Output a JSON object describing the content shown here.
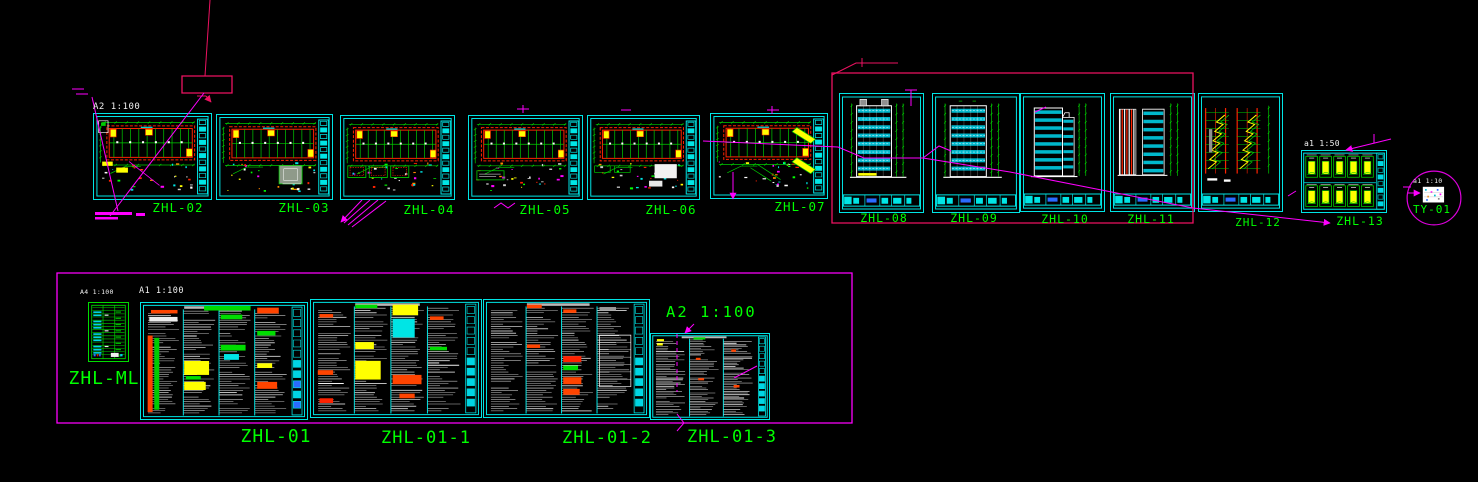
{
  "app": {
    "view": "cad-model-space-overview"
  },
  "palette": {
    "cyan": "#00e5e5",
    "green": "#00ff00",
    "dimgreen": "#00cc00",
    "magenta": "#ff00ff",
    "crimson": "#ed1261",
    "yellow": "#ffff00",
    "red": "#ff2200",
    "white": "#ffffff",
    "blue": "#2a6bff",
    "gray": "#909090",
    "band": "#00b8cc"
  },
  "sheets": [
    {
      "id": "ZHL-02",
      "label": "ZHL-02",
      "type": "plan",
      "special": "02",
      "x": 93,
      "y": 113,
      "w": 119,
      "h": 87,
      "lx": 178,
      "ly": 202,
      "fs": 12.5
    },
    {
      "id": "ZHL-03",
      "label": "ZHL-03",
      "type": "plan",
      "special": "03",
      "x": 216,
      "y": 114,
      "w": 117,
      "h": 86,
      "lx": 304,
      "ly": 202,
      "fs": 12.5
    },
    {
      "id": "ZHL-04",
      "label": "ZHL-04",
      "type": "plan",
      "special": "04",
      "x": 340,
      "y": 115,
      "w": 115,
      "h": 85,
      "lx": 429,
      "ly": 204,
      "fs": 12.5
    },
    {
      "id": "ZHL-05",
      "label": "ZHL-05",
      "type": "plan",
      "special": "05",
      "x": 468,
      "y": 115,
      "w": 115,
      "h": 85,
      "lx": 545,
      "ly": 204,
      "fs": 12.5
    },
    {
      "id": "ZHL-06",
      "label": "ZHL-06",
      "type": "plan",
      "special": "06",
      "x": 587,
      "y": 115,
      "w": 113,
      "h": 85,
      "lx": 671,
      "ly": 204,
      "fs": 12.5
    },
    {
      "id": "ZHL-07",
      "label": "ZHL-07",
      "type": "plan",
      "special": "07",
      "x": 710,
      "y": 113,
      "w": 118,
      "h": 86,
      "lx": 800,
      "ly": 201,
      "fs": 12.5
    },
    {
      "id": "ZHL-08",
      "label": "ZHL-08",
      "type": "elev",
      "kind": "front",
      "roof": true,
      "x": 839,
      "y": 93,
      "w": 85,
      "h": 120,
      "lx": 884,
      "ly": 213,
      "fs": 11.5
    },
    {
      "id": "ZHL-09",
      "label": "ZHL-09",
      "type": "elev",
      "kind": "front",
      "roof": false,
      "x": 932,
      "y": 93,
      "w": 88,
      "h": 120,
      "lx": 974,
      "ly": 213,
      "fs": 11.5
    },
    {
      "id": "ZHL-10",
      "label": "ZHL-10",
      "type": "elev",
      "kind": "step",
      "x": 1020,
      "y": 93,
      "w": 85,
      "h": 119,
      "lx": 1065,
      "ly": 214,
      "fs": 11.5
    },
    {
      "id": "ZHL-11",
      "label": "ZHL-11",
      "type": "elev",
      "kind": "pair",
      "x": 1110,
      "y": 93,
      "w": 85,
      "h": 119,
      "lx": 1151,
      "ly": 214,
      "fs": 11.5
    },
    {
      "id": "ZHL-12",
      "label": "ZHL-12",
      "type": "elev",
      "kind": "section",
      "x": 1198,
      "y": 93,
      "w": 85,
      "h": 119,
      "lx": 1258,
      "ly": 217,
      "fs": 11
    },
    {
      "id": "ZHL-13",
      "label": "ZHL-13",
      "type": "details",
      "x": 1301,
      "y": 150,
      "w": 86,
      "h": 63,
      "lx": 1360,
      "ly": 216,
      "fs": 11.5
    },
    {
      "id": "TY-01",
      "label": "TY-01",
      "type": "ty",
      "x": 1406,
      "y": 170,
      "w": 56,
      "h": 56,
      "lx": 1432,
      "ly": 204,
      "fs": 11
    },
    {
      "id": "ZHL-ML",
      "label": "ZHL-ML",
      "type": "ml",
      "x": 88,
      "y": 302,
      "w": 41,
      "h": 60,
      "lx": 104,
      "ly": 370,
      "fs": 18
    },
    {
      "id": "ZHL-01",
      "label": "ZHL-01",
      "type": "spec",
      "cols": 4,
      "strip": "blue",
      "x": 140,
      "y": 302,
      "w": 168,
      "h": 118,
      "lx": 276,
      "ly": 428,
      "fs": 18,
      "patches": [
        [
          38,
          2.5,
          28,
          4,
          "#00dd00"
        ],
        [
          4,
          28,
          3,
          66,
          "#ff4400"
        ],
        [
          8,
          30,
          3,
          62,
          "#00cc00"
        ],
        [
          6,
          6,
          16,
          3,
          "#ff4400"
        ],
        [
          5,
          12,
          17,
          4,
          "#eeeeee"
        ],
        [
          26,
          50,
          15,
          12,
          "#ffff00"
        ],
        [
          26,
          68,
          13,
          7,
          "#ffff00"
        ],
        [
          27,
          63,
          9,
          3,
          "#00dd00"
        ],
        [
          48,
          10,
          13,
          4,
          "#00dd00"
        ],
        [
          48,
          36,
          15,
          5,
          "#00dd00"
        ],
        [
          50,
          44,
          9,
          5,
          "#00e5e5"
        ],
        [
          70,
          4,
          13,
          5,
          "#ff4400"
        ],
        [
          70,
          24,
          11,
          4,
          "#00dd00"
        ],
        [
          70,
          52,
          9,
          4,
          "#ffff00"
        ],
        [
          70,
          68,
          12,
          6,
          "#ff4400"
        ]
      ]
    },
    {
      "id": "ZHL-01-1",
      "label": "ZHL-01-1",
      "type": "spec",
      "cols": 4,
      "strip": "cyan",
      "x": 310,
      "y": 299,
      "w": 172,
      "h": 119,
      "lx": 426,
      "ly": 430,
      "fs": 17,
      "patches": [
        [
          5,
          12,
          8,
          3,
          "#ff4400"
        ],
        [
          4,
          60,
          9,
          4,
          "#ff4400"
        ],
        [
          5,
          84,
          8,
          4,
          "#ff2200"
        ],
        [
          26,
          4,
          13,
          3,
          "#00dd00"
        ],
        [
          26,
          36,
          11,
          6,
          "#ffff00"
        ],
        [
          26,
          52,
          15,
          16,
          "#ffff00"
        ],
        [
          48,
          4,
          15,
          9,
          "#ffff00"
        ],
        [
          48,
          16,
          13,
          16,
          "#00e5e5"
        ],
        [
          48,
          64,
          17,
          8,
          "#ff4400"
        ],
        [
          52,
          80,
          9,
          4,
          "#ff4400"
        ],
        [
          70,
          14,
          8,
          3,
          "#ff4400"
        ],
        [
          70,
          40,
          10,
          3,
          "#00dd00"
        ]
      ]
    },
    {
      "id": "ZHL-01-2",
      "label": "ZHL-01-2",
      "type": "spec",
      "cols": 4,
      "strip": "cyan",
      "x": 483,
      "y": 299,
      "w": 167,
      "h": 119,
      "lx": 607,
      "ly": 430,
      "fs": 17,
      "patches": [
        [
          26,
          4,
          9,
          3,
          "#ff4400"
        ],
        [
          26,
          38,
          8,
          3,
          "#ff4400"
        ],
        [
          48,
          8,
          8,
          3,
          "#ff4400"
        ],
        [
          48,
          48,
          11,
          5,
          "#ff2200"
        ],
        [
          48,
          56,
          9,
          4,
          "#00dd00"
        ],
        [
          48,
          66,
          11,
          6,
          "#ff4400"
        ],
        [
          48,
          76,
          10,
          5,
          "#ff4400"
        ],
        [
          70,
          30,
          19,
          44,
          "grid"
        ],
        [
          70,
          6,
          10,
          3,
          "#999999"
        ]
      ]
    },
    {
      "id": "ZHL-01-3",
      "label": "ZHL-01-3",
      "type": "spec",
      "cols": 3,
      "strip": "cyan",
      "x": 650,
      "y": 333,
      "w": 120,
      "h": 87,
      "lx": 732,
      "ly": 429,
      "fs": 17,
      "patches": [
        [
          5,
          6,
          6,
          2.5,
          "#ffff00"
        ],
        [
          5,
          11,
          5,
          2.5,
          "#ffff00"
        ],
        [
          36,
          4,
          10,
          2.5,
          "#00dd00"
        ],
        [
          38,
          28,
          4,
          2.5,
          "#ff4400"
        ],
        [
          40,
          52,
          5,
          2.5,
          "#ff4400"
        ],
        [
          68,
          18,
          4,
          3,
          "#ff4400"
        ],
        [
          70,
          60,
          5,
          3,
          "#ff4400"
        ]
      ]
    }
  ],
  "frames": [
    {
      "name": "revision-callout-box",
      "x": 182,
      "y": 76,
      "w": 50,
      "h": 17,
      "color": "#ed1261"
    },
    {
      "name": "elevation-group-frame",
      "x": 832,
      "y": 73,
      "w": 361,
      "h": 150,
      "color": "#ed1261"
    },
    {
      "name": "schedule-group-frame",
      "x": 57,
      "y": 273,
      "w": 795,
      "h": 150,
      "color": "#ff00ff"
    }
  ],
  "scale_labels": [
    {
      "text": "A2 1:100",
      "x": 93,
      "y": 103,
      "fs": 9,
      "color": "#f0f0f0",
      "ls": 0.5
    },
    {
      "text": "A4 1:100",
      "x": 80,
      "y": 289,
      "fs": 6.5,
      "color": "#f0f0f0",
      "ls": 0.3
    },
    {
      "text": "A1 1:100",
      "x": 139,
      "y": 287,
      "fs": 8.5,
      "color": "#f0f0f0",
      "ls": 0.5
    },
    {
      "text": "A2  1:100",
      "x": 666,
      "y": 305,
      "fs": 15.5,
      "color": "#00ff00",
      "ls": 2
    },
    {
      "text": "a1 1:50",
      "x": 1304,
      "y": 140,
      "fs": 8,
      "color": "#f0f0f0",
      "ls": 0.3
    },
    {
      "text": "a1 1:10",
      "x": 1413,
      "y": 178,
      "fs": 6.5,
      "color": "#f0f0f0",
      "ls": 0.3
    }
  ],
  "leader_lines": [
    {
      "pts": [
        [
          210,
          0
        ],
        [
          205,
          76
        ]
      ],
      "c": "c"
    },
    {
      "pts": [
        [
          197,
          96
        ],
        [
          206,
          96
        ]
      ],
      "c": "c"
    },
    {
      "pts": [
        [
          206,
          96
        ],
        [
          211,
          102
        ]
      ],
      "c": "c",
      "arrow": "end"
    },
    {
      "pts": [
        [
          204,
          93
        ],
        [
          110,
          216
        ]
      ],
      "c": "m"
    },
    {
      "pts": [
        [
          92,
          97
        ],
        [
          118,
          211
        ]
      ],
      "c": "m"
    },
    {
      "pts": [
        [
          72,
          89
        ],
        [
          84,
          89
        ]
      ],
      "c": "m"
    },
    {
      "pts": [
        [
          76,
          94
        ],
        [
          88,
          94
        ]
      ],
      "c": "m"
    },
    {
      "pts": [
        [
          832,
          75
        ],
        [
          856,
          63
        ],
        [
          898,
          63
        ]
      ],
      "c": "c"
    },
    {
      "pts": [
        [
          862,
          58
        ],
        [
          862,
          67
        ]
      ],
      "c": "c"
    },
    {
      "pts": [
        [
          703,
          141
        ],
        [
          838,
          147
        ],
        [
          864,
          158
        ],
        [
          923,
          158
        ],
        [
          1010,
          172
        ],
        [
          1193,
          208
        ],
        [
          1330,
          223
        ]
      ],
      "c": "m",
      "arrow": "end"
    },
    {
      "pts": [
        [
          923,
          158
        ],
        [
          939,
          146
        ],
        [
          951,
          151
        ]
      ],
      "c": "m"
    },
    {
      "pts": [
        [
          733,
          172
        ],
        [
          733,
          199
        ]
      ],
      "c": "m",
      "arrow": "end"
    },
    {
      "pts": [
        [
          1346,
          150
        ],
        [
          1391,
          139
        ]
      ],
      "c": "m",
      "arrow": "start"
    },
    {
      "pts": [
        [
          1374,
          134
        ],
        [
          1374,
          143
        ]
      ],
      "c": "m"
    },
    {
      "pts": [
        [
          1408,
          193
        ],
        [
          1420,
          193
        ]
      ],
      "c": "m",
      "arrow": "end"
    },
    {
      "pts": [
        [
          1403,
          187
        ],
        [
          1411,
          187
        ]
      ],
      "c": "m"
    },
    {
      "pts": [
        [
          362,
          200
        ],
        [
          341,
          222
        ]
      ],
      "c": "m",
      "arrow": "end"
    },
    {
      "pts": [
        [
          370,
          200
        ],
        [
          344,
          223
        ]
      ],
      "c": "m"
    },
    {
      "pts": [
        [
          378,
          200
        ],
        [
          348,
          225
        ]
      ],
      "c": "m"
    },
    {
      "pts": [
        [
          386,
          201
        ],
        [
          352,
          227
        ]
      ],
      "c": "m"
    },
    {
      "pts": [
        [
          494,
          208
        ],
        [
          501,
          203
        ],
        [
          508,
          208
        ],
        [
          515,
          203
        ]
      ],
      "c": "m"
    },
    {
      "pts": [
        [
          517,
          109
        ],
        [
          529,
          109
        ]
      ],
      "c": "m"
    },
    {
      "pts": [
        [
          523,
          105
        ],
        [
          523,
          113
        ]
      ],
      "c": "m"
    },
    {
      "pts": [
        [
          621,
          110
        ],
        [
          631,
          110
        ]
      ],
      "c": "m"
    },
    {
      "pts": [
        [
          767,
          110
        ],
        [
          779,
          110
        ]
      ],
      "c": "m"
    },
    {
      "pts": [
        [
          772,
          106
        ],
        [
          772,
          114
        ]
      ],
      "c": "m"
    },
    {
      "pts": [
        [
          905,
          90
        ],
        [
          917,
          90
        ]
      ],
      "c": "m"
    },
    {
      "pts": [
        [
          911,
          90
        ],
        [
          911,
          106
        ]
      ],
      "c": "m"
    },
    {
      "pts": [
        [
          1035,
          112
        ],
        [
          1046,
          107
        ]
      ],
      "c": "m"
    },
    {
      "pts": [
        [
          1288,
          196
        ],
        [
          1296,
          191
        ]
      ],
      "c": "m"
    },
    {
      "pts": [
        [
          694,
          324
        ],
        [
          685,
          333
        ]
      ],
      "c": "m",
      "arrow": "end"
    },
    {
      "pts": [
        [
          677,
          334
        ],
        [
          677,
          392
        ]
      ],
      "c": "m",
      "dash": true
    },
    {
      "pts": [
        [
          677,
          414
        ],
        [
          684,
          423
        ],
        [
          677,
          431
        ]
      ],
      "c": "m"
    },
    {
      "pts": [
        [
          734,
          378
        ],
        [
          757,
          366
        ]
      ],
      "c": "m"
    }
  ],
  "text_bars": [
    {
      "x": 95,
      "y": 212,
      "w": 37,
      "h": 3
    },
    {
      "x": 136,
      "y": 213,
      "w": 9,
      "h": 3
    },
    {
      "x": 95,
      "y": 217,
      "w": 23,
      "h": 2.5
    }
  ]
}
